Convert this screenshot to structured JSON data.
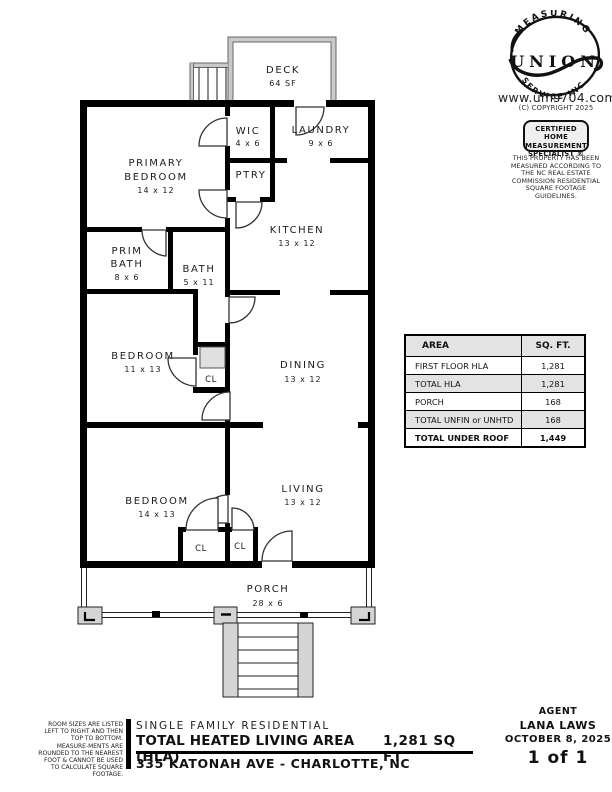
{
  "branding": {
    "logo_arc_top": "MEASURING",
    "logo_name": "UNION",
    "logo_arc_bottom": "SERVICE   INC.",
    "website": "www.ums704.com",
    "copyright": "(C) COPYRIGHT 2025",
    "badge_line1": "CERTIFIED HOME",
    "badge_line2": "MEASUREMENT",
    "badge_line3": "SPECIALIST ®",
    "nc_disclaimer": "THIS PROPERTY HAS BEEN MEASURED ACCORDING TO THE NC REAL ESTATE COMMISSION RESIDENTIAL SQUARE FOOTAGE GUIDELINES."
  },
  "plan": {
    "deck": {
      "name": "DECK",
      "area": "64 SF"
    },
    "wic": {
      "name": "WIC",
      "dims": "4 x 6"
    },
    "laundry": {
      "name": "LAUNDRY",
      "dims": "9 x 6"
    },
    "primary_bedroom": {
      "line1": "PRIMARY",
      "line2": "BEDROOM",
      "dims": "14 x 12"
    },
    "pantry": {
      "name": "PTRY"
    },
    "kitchen": {
      "name": "KITCHEN",
      "dims": "13 x 12"
    },
    "prim_bath": {
      "line1": "PRIM",
      "line2": "BATH",
      "dims": "8 x 6"
    },
    "bath": {
      "name": "BATH",
      "dims": "5 x 11"
    },
    "bedroom2": {
      "name": "BEDROOM",
      "dims": "11 x 13"
    },
    "closet1": {
      "name": "CL"
    },
    "dining": {
      "name": "DINING",
      "dims": "13 x 12"
    },
    "bedroom3": {
      "name": "BEDROOM",
      "dims": "14 x 13"
    },
    "closet2": {
      "name": "CL"
    },
    "closet3": {
      "name": "CL"
    },
    "living": {
      "name": "LIVING",
      "dims": "13 x 12"
    },
    "porch": {
      "name": "PORCH",
      "dims": "28 x 6"
    }
  },
  "area_table": {
    "headers": [
      "AREA",
      "SQ. FT."
    ],
    "rows": [
      {
        "label": "FIRST FLOOR HLA",
        "value": "1,281"
      },
      {
        "label": "TOTAL HLA",
        "value": "1,281"
      },
      {
        "label": "PORCH",
        "value": "168"
      },
      {
        "label": "TOTAL UNFIN or UNHTD",
        "value": "168"
      },
      {
        "label": "TOTAL UNDER ROOF",
        "value": "1,449"
      }
    ]
  },
  "footer": {
    "side_note": "ROOM SIZES ARE LISTED LEFT TO RIGHT AND THEN TOP TO BOTTOM. MEASURE-MENTS ARE ROUNDED TO THE NEAREST FOOT & CANNOT BE USED TO CALCULATE SQUARE FOOTAGE.",
    "property_type": "SINGLE FAMILY RESIDENTIAL",
    "hla_label": "TOTAL HEATED LIVING AREA (HLA)",
    "hla_value": "1,281 SQ FT",
    "address": "335 KATONAH AVE - CHARLOTTE, NC",
    "agent_label": "AGENT",
    "agent_name": "LANA LAWS",
    "date": "OCTOBER 8, 2025",
    "page": "1 of 1"
  }
}
